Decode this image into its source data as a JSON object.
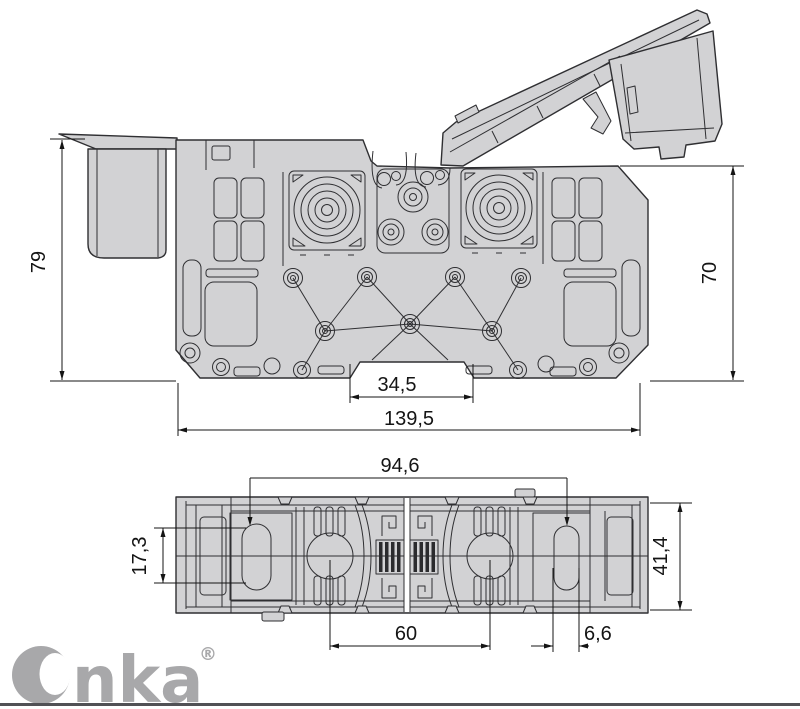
{
  "drawing": {
    "side_view": {
      "height_left": "79",
      "height_right": "70",
      "notch_width": "34,5",
      "overall_width": "139,5"
    },
    "plan_view": {
      "hole_spacing": "94,6",
      "overall_depth": "41,4",
      "slot_height": "17,3",
      "clamp_spacing": "60",
      "slot_width": "6,6"
    }
  },
  "brand": {
    "name": "Onka",
    "wordmark_tail": "nka",
    "registered_mark": "®"
  },
  "colors": {
    "background": "#ffffff",
    "body_fill": "#d2d2d4",
    "outline": "#2f2f32",
    "dimension": "#141414",
    "logo": "#a8a8aa",
    "footer_rule": "#515155",
    "hatch": "#2b2b2e"
  }
}
